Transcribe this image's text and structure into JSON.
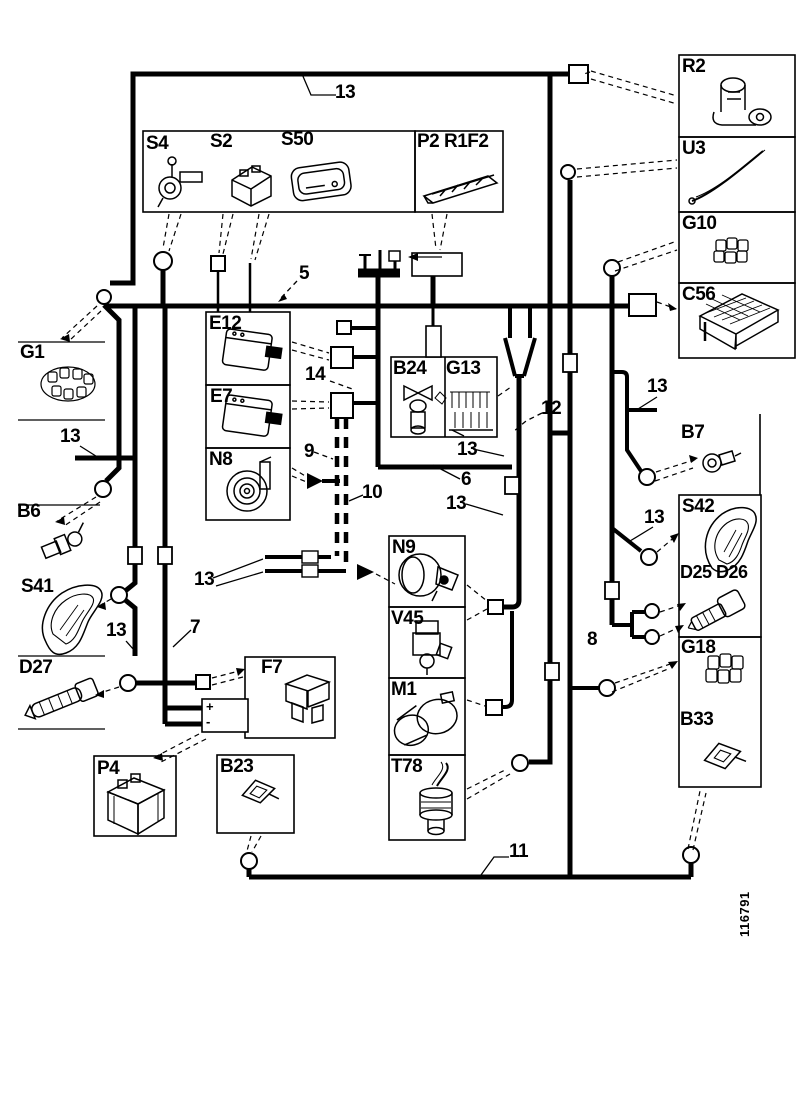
{
  "part_number": "116791",
  "colors": {
    "line": "#000000",
    "background": "#ffffff"
  },
  "labels": {
    "s4": "S4",
    "s2": "S2",
    "s50": "S50",
    "p2r1f2": "P2 R1F2",
    "e12": "E12",
    "e7": "E7",
    "n8": "N8",
    "b24": "B24",
    "g13": "G13",
    "n9": "N9",
    "v45": "V45",
    "m1": "M1",
    "t78": "T78",
    "f7": "F7",
    "p4": "P4",
    "b23": "B23",
    "r2": "R2",
    "u3": "U3",
    "g10": "G10",
    "c56": "C56",
    "b7": "B7",
    "s42": "S42",
    "d25d26": "D25 D26",
    "g18": "G18",
    "b33": "B33",
    "g1": "G1",
    "b6": "B6",
    "s41": "S41",
    "d27": "D27"
  },
  "wire_numbers": {
    "n13_top": "13",
    "n5": "5",
    "n14": "14",
    "n9": "9",
    "n10": "10",
    "n13_b24": "13",
    "n6": "6",
    "n13_mid": "13",
    "n12": "12",
    "n13_pair": "13",
    "n13_left": "13",
    "n13_s41": "13",
    "n7": "7",
    "n8": "8",
    "n13_b7": "13",
    "n13_s42": "13",
    "n11": "11"
  },
  "terminals": {
    "plus": "+",
    "minus": "-"
  }
}
